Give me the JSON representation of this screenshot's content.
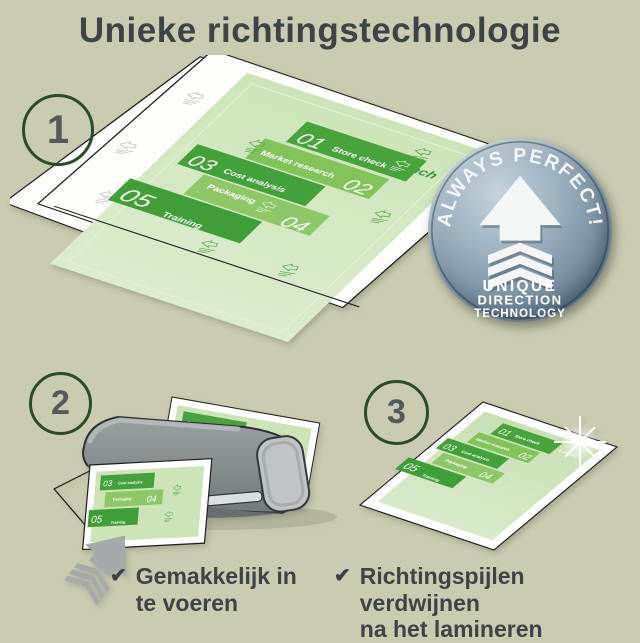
{
  "title": "Unieke richtingstechnologie",
  "steps": [
    {
      "number": "1"
    },
    {
      "number": "2"
    },
    {
      "number": "3"
    }
  ],
  "badge": {
    "arc_text": "ALWAYS PERFECT!",
    "line1": "UNIQUE",
    "line2": "DIRECTION",
    "line3": "TECHNOLOGY"
  },
  "doc": {
    "launch": "Launch",
    "items": [
      {
        "num": "01",
        "label": "Store check"
      },
      {
        "num": "02",
        "label": "Market research"
      },
      {
        "num": "03",
        "label": "Cost analysis"
      },
      {
        "num": "04",
        "label": "Packaging"
      },
      {
        "num": "05",
        "label": "Training"
      }
    ]
  },
  "captions": [
    {
      "line1": "Gemakkelijk in",
      "line2": "te voeren"
    },
    {
      "line1": "Richtingspijlen verdwijnen",
      "line2": "na het lamineren"
    }
  ],
  "check_icon": "✔",
  "colors": {
    "background": "#cacbb1",
    "text": "#3e4347",
    "circle_stroke": "#2c4b28",
    "green_dark": "#44a03a",
    "green_mid": "#48a33c",
    "green_light": "#8dc768",
    "doc_pale": "#cde4b8",
    "badge_base": "#72899b",
    "gray_arrow": "#a6aaab",
    "laminator_gray": "#7d8284"
  }
}
